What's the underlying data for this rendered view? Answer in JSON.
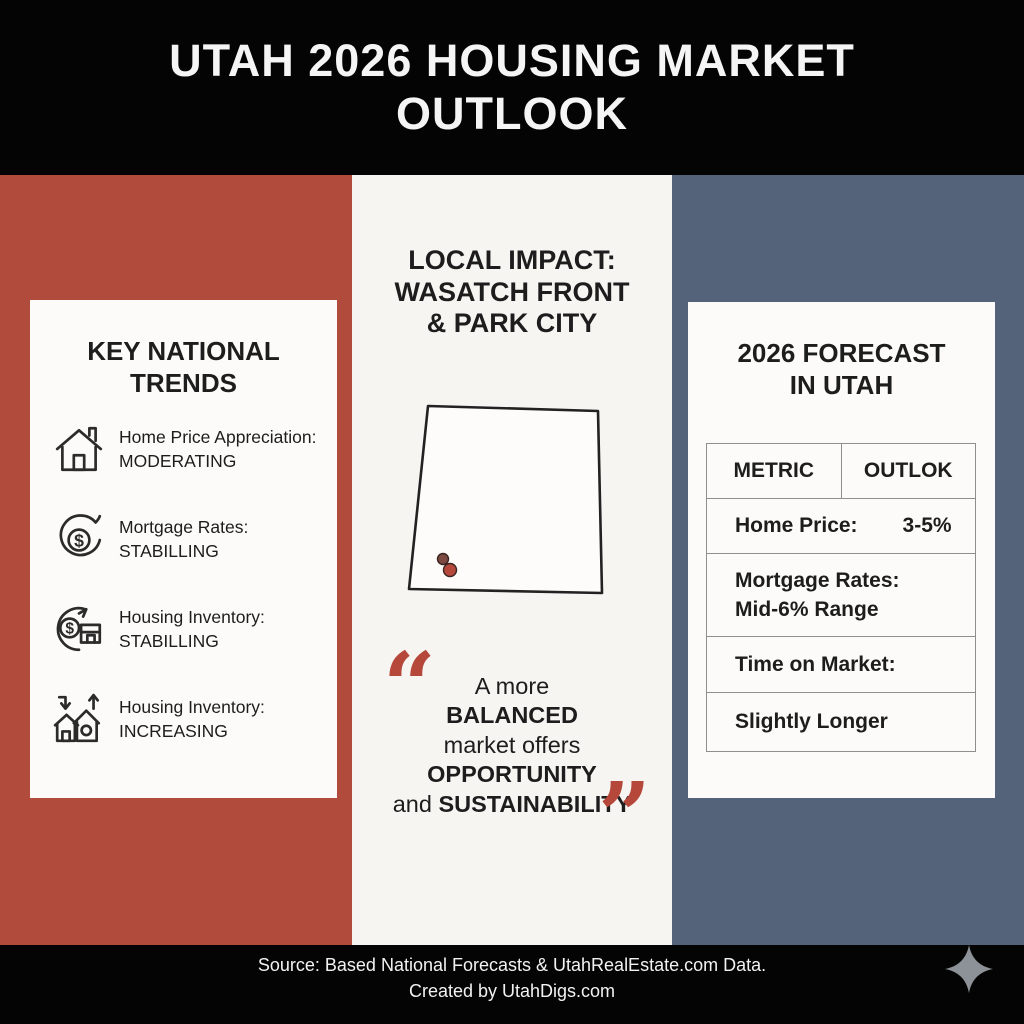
{
  "header": {
    "title_line1": "UTAH 2026 HOUSING MARKET",
    "title_line2": "OUTLOOK"
  },
  "left_panel": {
    "title_line1": "KEY NATIONAL",
    "title_line2": "TRENDS",
    "items": [
      {
        "icon": "house-icon",
        "label": "Home Price Appreciation:",
        "value": "MODERATING"
      },
      {
        "icon": "dollar-cycle-icon",
        "label": "Mortgage Rates:",
        "value": "STABILLING"
      },
      {
        "icon": "dollar-building-cycle-icon",
        "label": "Housing Inventory:",
        "value": "STABILLING"
      },
      {
        "icon": "houses-up-down-arrows-icon",
        "label": "Housing Inventory:",
        "value": "INCREASING"
      }
    ]
  },
  "middle_panel": {
    "heading_line1": "LOCAL IMPACT:",
    "heading_line2": "WASATCH FRONT",
    "heading_line3": "& PARK CITY",
    "map": {
      "name": "utah-state-outline",
      "markers": [
        {
          "cx": "43",
          "cy": "166",
          "r": "5.5",
          "color": "#7d4a42"
        },
        {
          "cx": "50",
          "cy": "177",
          "r": "6.5",
          "color": "#b5483a"
        }
      ]
    },
    "quote": {
      "open_mark": "“",
      "close_mark": "”",
      "line1": "A more",
      "line2": "BALANCED",
      "line3": "market offers",
      "line4": "OPPORTUNITY",
      "line5_regular": "and ",
      "line5_bold": "SUSTAINABILITY"
    }
  },
  "right_panel": {
    "title_line1": "2026 FORECAST",
    "title_line2": "IN UTAH",
    "table": {
      "header_metric": "METRIC",
      "header_outlook": "OUTLOK",
      "rows": [
        {
          "metric": "Home Price:",
          "outlook": "3-5%"
        },
        {
          "metric": "Mortgage Rates:",
          "outlook": "Mid-6% Range"
        },
        {
          "metric": "Time on Market:",
          "outlook": ""
        },
        {
          "metric": "Slightly Longer",
          "outlook": ""
        }
      ]
    }
  },
  "footer": {
    "line1": "Source: Based National Forecasts & UtahRealEstate.com Data.",
    "line2": "Created by UtahDigs.com"
  },
  "colors": {
    "red": "#b14b3c",
    "slate": "#54637a",
    "black": "#040404",
    "card": "#fcfbf9",
    "mid-white": "#f7f5f2",
    "text": "#1d1d1d",
    "quote-red": "#b5483a",
    "border": "#8f8f8f",
    "sparkle": "#8d9298"
  }
}
